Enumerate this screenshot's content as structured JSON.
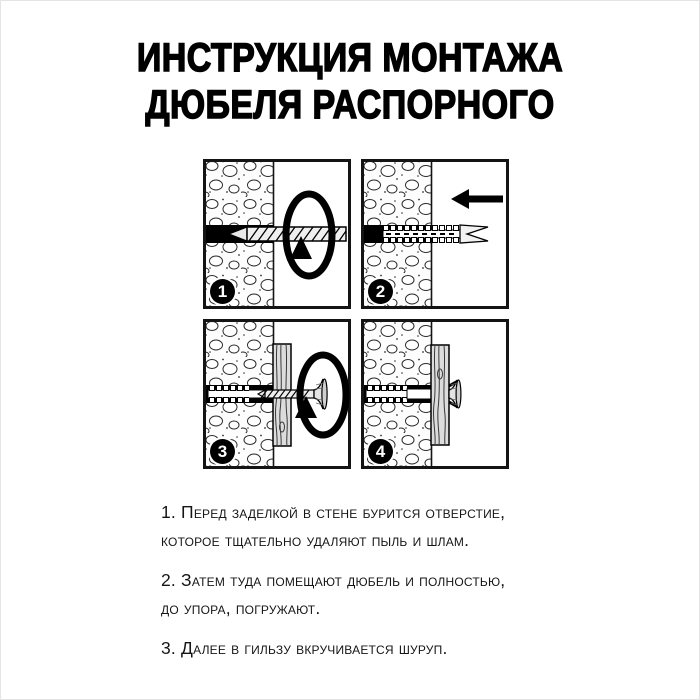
{
  "title": {
    "line1": "ИНСТРУКЦИЯ МОНТАЖА",
    "line2": "ДЮБЕЛЯ РАСПОРНОГО"
  },
  "steps": [
    {
      "number": "1",
      "illustration": "drill-boring-hole-in-wall-with-rotation-arrow"
    },
    {
      "number": "2",
      "illustration": "dowel-pushed-into-hole-with-left-arrow"
    },
    {
      "number": "3",
      "illustration": "screw-driven-through-board-into-dowel-with-rotation-arrow"
    },
    {
      "number": "4",
      "illustration": "finished-mount-screw-head-flush-on-board"
    }
  ],
  "instructions": [
    {
      "lines": [
        "1. Перед заделкой в стене бурится отверстие,",
        "которое тщательно удаляют пыль и шлам."
      ]
    },
    {
      "lines": [
        "2. Затем туда помещают дюбель и полностью,",
        "до упора, погружают."
      ]
    },
    {
      "lines": [
        "3. Далее в гильзу вкручивается шуруп."
      ]
    }
  ],
  "colors": {
    "ink": "#000000",
    "paper": "#ffffff"
  }
}
